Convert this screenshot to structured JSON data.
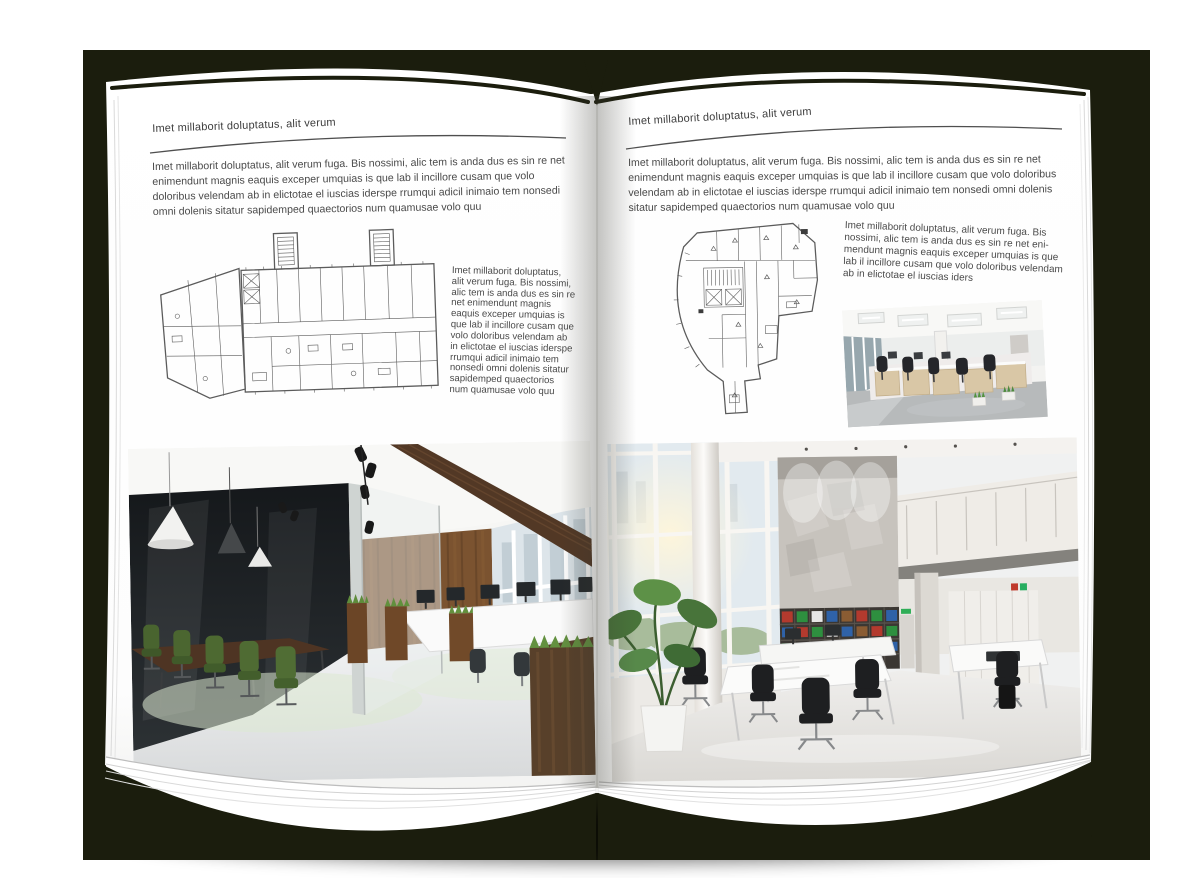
{
  "mockup": {
    "background_color": "#1b1d0d",
    "page_color": "#ffffff",
    "text_color": "#434343"
  },
  "left_page": {
    "header": "Imet millaborit doluptatus, alit verum",
    "intro": "Imet millaborit doluptatus, alit verum fuga. Bis nossimi, alic tem is anda dus es sin re net enimendunt magnis eaquis exceper umquias is que lab il incillore cusam que volo doloribus velendam ab in elictotae el iuscias iderspe rrumqui adicil inimaio tem nonsedi omni dolenis sitatur sapidemped quaectorios num quamusae volo quu",
    "sidebar": "Imet millaborit doluptatus, alit verum fuga. Bis nossimi, alic tem is anda dus es sin re net enimendunt magnis eaquis exceper umquias is que lab il incillore cusam que volo doloribus velendam ab in elictotae el iuscias iderspe rrumqui adicil inimaio tem nonsedi omni dolenis sitatur sapidemped quaectorios num quamusae volo quu",
    "floor_plan": "wide-office-building-floor-plan-drawing",
    "photo": "office-interior-photo-dark-glass-meeting-room-wood-wall"
  },
  "right_page": {
    "header": "Imet millaborit doluptatus, alit verum",
    "intro": "Imet millaborit doluptatus, alit verum fuga. Bis nossimi, alic tem is anda dus es sin re net enimendunt magnis eaquis exceper umquias is que lab il incillore cusam que volo doloribus velendam ab in elictotae el iuscias iderspe rrumqui adicil inimaio tem nonsedi omni dolenis sitatur sapidemped quaectorios num quamusae volo quu",
    "sidebar": "Imet millaborit doluptatus, alit verum fuga. Bis nossimi, alic tem is anda dus es sin re net eni-mendunt magnis eaquis exceper umquias is que lab il incillore cusam que volo doloribus velendam ab in elictotae el iuscias iders",
    "floor_plan": "irregular-office-building-floor-plan-drawing",
    "photo_small": "open-office-workstations-photo",
    "photo_large": "bright-atrium-office-photo"
  }
}
